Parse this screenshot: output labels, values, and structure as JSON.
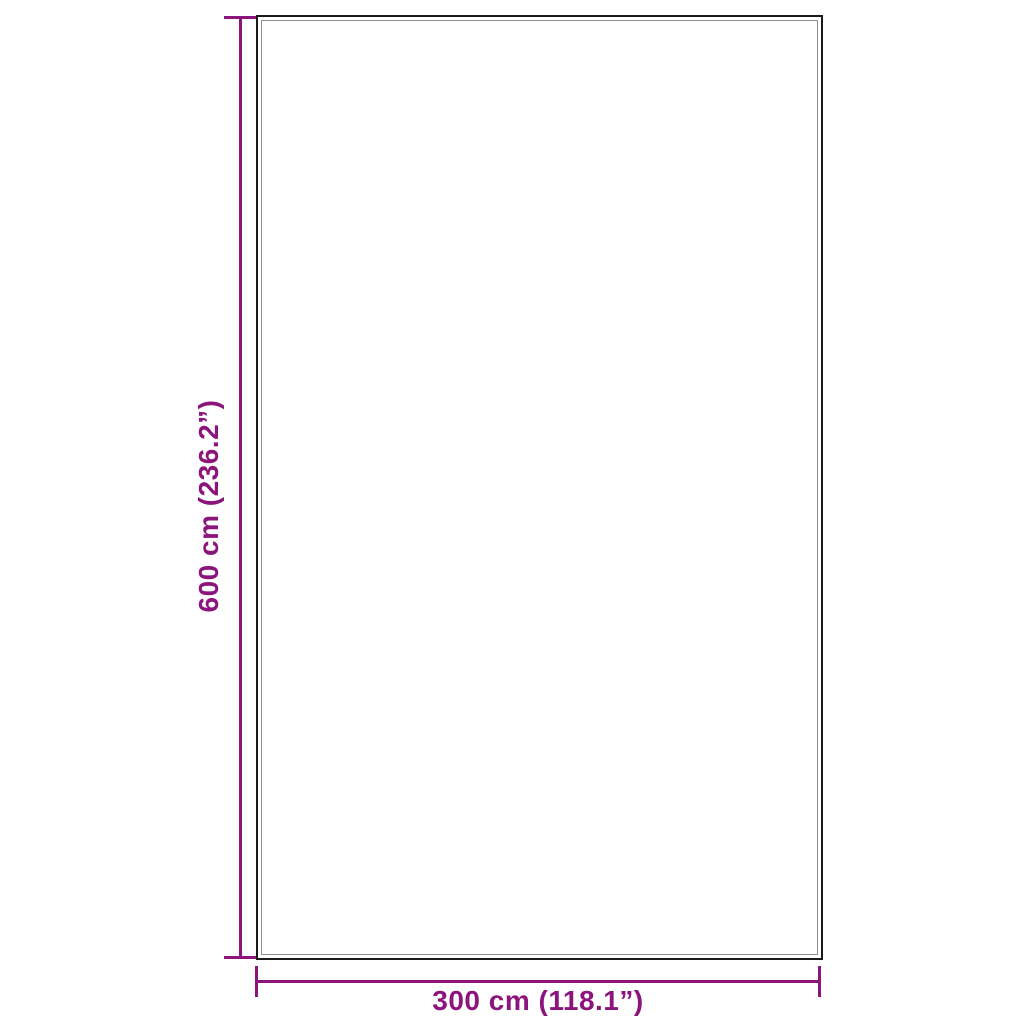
{
  "diagram": {
    "type": "product-dimension-diagram",
    "height_label": "600 cm (236.2”)",
    "width_label": "300 cm (118.1”)",
    "colors": {
      "dimension": "#8C147D",
      "panel_border": "#1A1A1A",
      "panel_inner_line": "#8E8E8E"
    }
  }
}
